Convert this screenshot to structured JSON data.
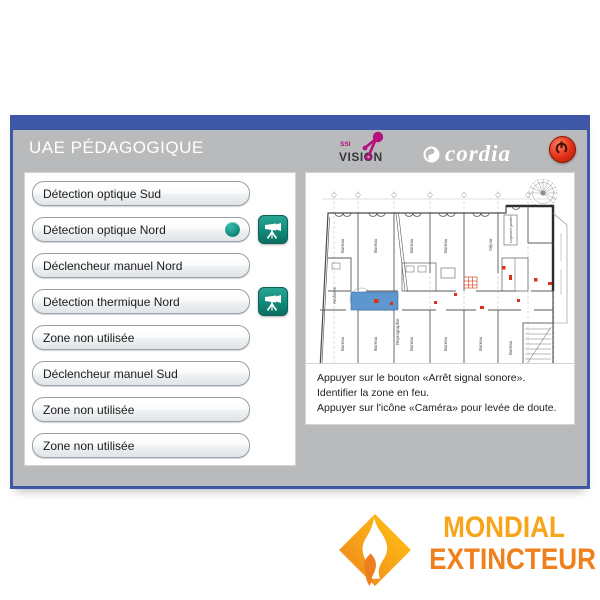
{
  "window": {
    "title": "UAE PÉDAGOGIQUE",
    "logos": {
      "ssi_small": "SSI",
      "ssi_big": "VISION",
      "cordia": "cordia"
    },
    "zone_buttons": [
      {
        "label": "Détection optique Sud",
        "camera": false,
        "active": false
      },
      {
        "label": "Détection optique Nord",
        "camera": true,
        "active": true
      },
      {
        "label": "Déclencheur manuel Nord",
        "camera": false,
        "active": false
      },
      {
        "label": "Détection thermique Nord",
        "camera": true,
        "active": false
      },
      {
        "label": "Zone non utilisée",
        "camera": false,
        "active": false
      },
      {
        "label": "Déclencheur manuel Sud",
        "camera": false,
        "active": false
      },
      {
        "label": "Zone non utilisée",
        "camera": false,
        "active": false
      },
      {
        "label": "Zone non utilisée",
        "camera": false,
        "active": false
      }
    ],
    "instructions": [
      "Appuyer sur le bouton «Arrêt signal sonore».",
      "Identifier la zone en feu.",
      "Appuyer sur l'icône «Caméra» pour levée de doute."
    ],
    "plan": {
      "room_label": "Bureau",
      "archives": "Archives",
      "repro": "Reprographie",
      "logement": "Logement gardien",
      "sejour": "Séjour"
    }
  },
  "footer": {
    "brand_line1": "MONDIAL",
    "brand_line2": "EXTINCTEUR"
  },
  "colors": {
    "window_blue": "#3f57a7",
    "window_gray": "#b9babc",
    "teal_accent": "#11897a",
    "alarm_red": "#d63417",
    "zone_blue": "#5e97cf",
    "magenta_logo": "#b5107d",
    "brand_yellow": "#f9a51c",
    "brand_orange": "#f0801b"
  }
}
